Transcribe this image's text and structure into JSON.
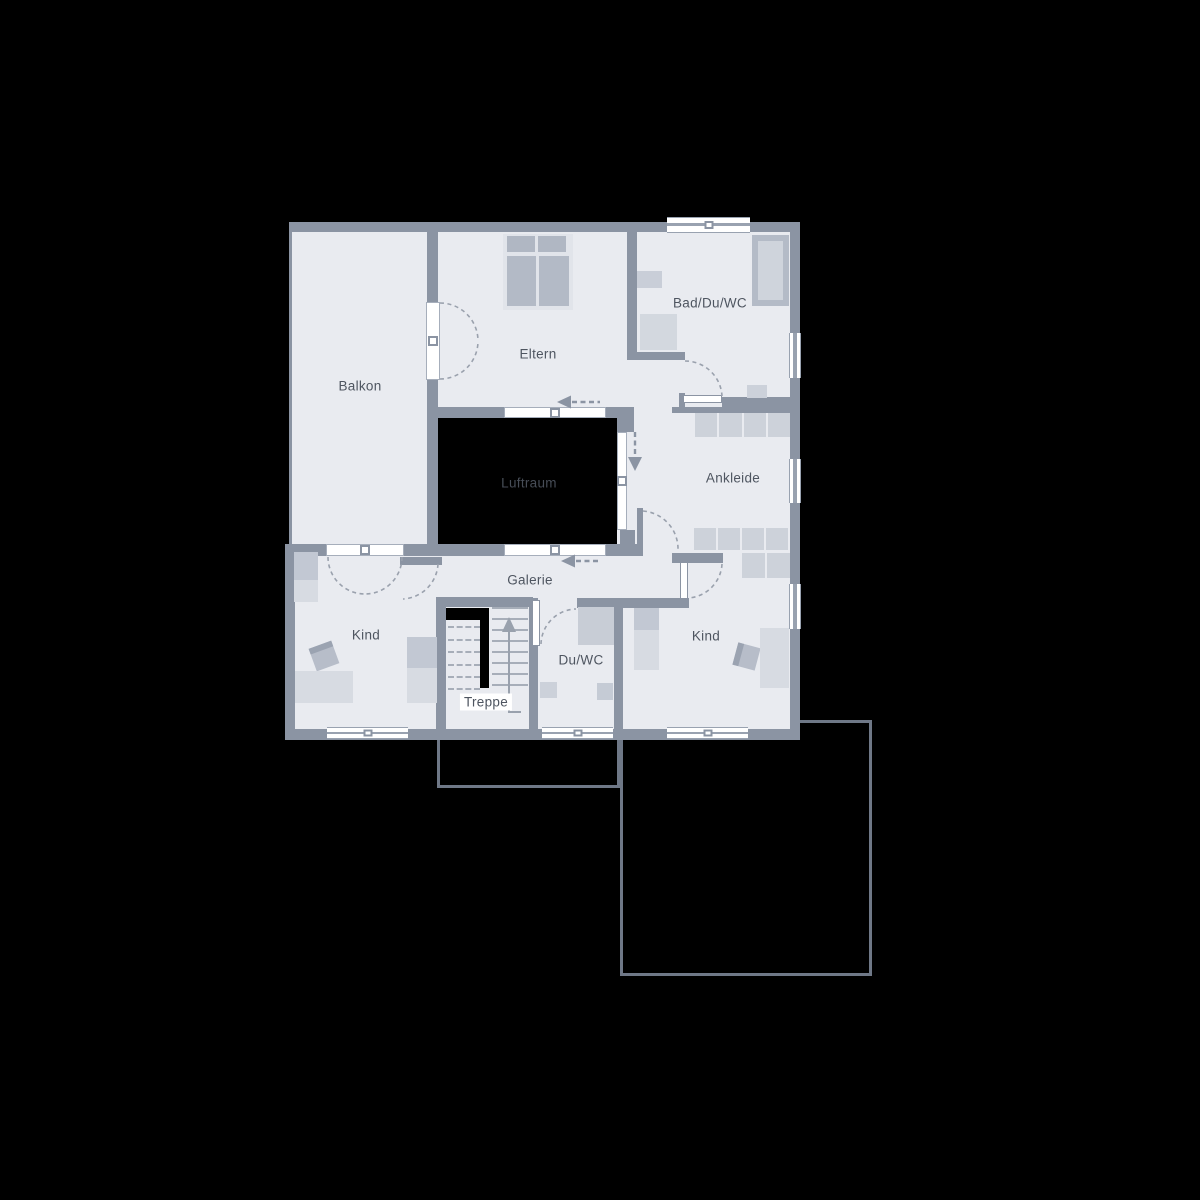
{
  "rooms": {
    "balkon": "Balkon",
    "eltern": "Eltern",
    "bad": "Bad/Du/WC",
    "ankleide": "Ankleide",
    "luftraum": "Luftraum",
    "galerie": "Galerie",
    "kind_left": "Kind",
    "treppe": "Treppe",
    "duwc": "Du/WC",
    "kind_right": "Kind"
  },
  "colors": {
    "background": "#000000",
    "wall": "#8b94a3",
    "room_fill": "#e9ebf0",
    "window_white": "#ffffff",
    "furniture_light": "#d7dbe2",
    "furniture_mid": "#c2c8d3",
    "furniture_dark": "#b4bbc7",
    "void": "#000000",
    "outline_stroke": "#6f7887",
    "label_text": "#4e5560",
    "void_label_text": "#474d57",
    "dash": "#9aa1ad"
  }
}
